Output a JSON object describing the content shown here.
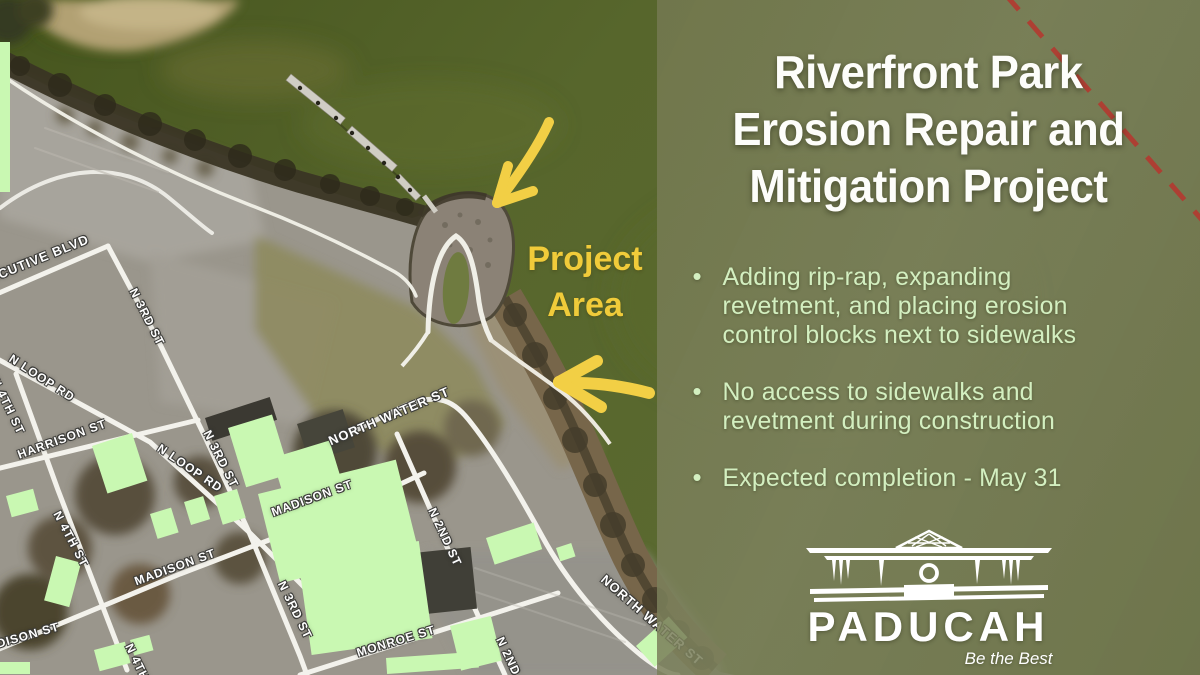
{
  "panel": {
    "title_lines": [
      "Riverfront Park",
      "Erosion Repair and",
      "Mitigation Project"
    ],
    "bullets": [
      "Adding rip-rap, expanding\nrevetment, and placing erosion\ncontrol blocks next to sidewalks",
      "No access to sidewalks and\nrevetment during construction",
      "Expected completion - May 31"
    ],
    "logo": {
      "city": "PADUCAH",
      "tagline": "Be the Best"
    },
    "colors": {
      "panel_olive": "#767C52",
      "bullet_green": "#D3EFC0",
      "title_white": "#FDFDFA",
      "dashed_line_red": "#B23B31"
    }
  },
  "map": {
    "annotation": {
      "line1": "Project",
      "line2": "Area",
      "color": "#F0CB3A"
    },
    "arrow_color": "#F2CF45",
    "street_labels": [
      "EXECUTIVE BLVD",
      "N 3RD ST",
      "N LOOP RD",
      "N 4TH ST",
      "HARRISON ST",
      "N LOOP RD",
      "N 3RD ST",
      "N 4TH ST",
      "MADISON ST",
      "MADISON ST",
      "MADISON ST",
      "N 3RD ST",
      "N 4TH ST",
      "NORTH WATER ST",
      "N 2ND ST",
      "MONROE ST",
      "NORTH WATER ST",
      "N 2ND ST"
    ]
  }
}
